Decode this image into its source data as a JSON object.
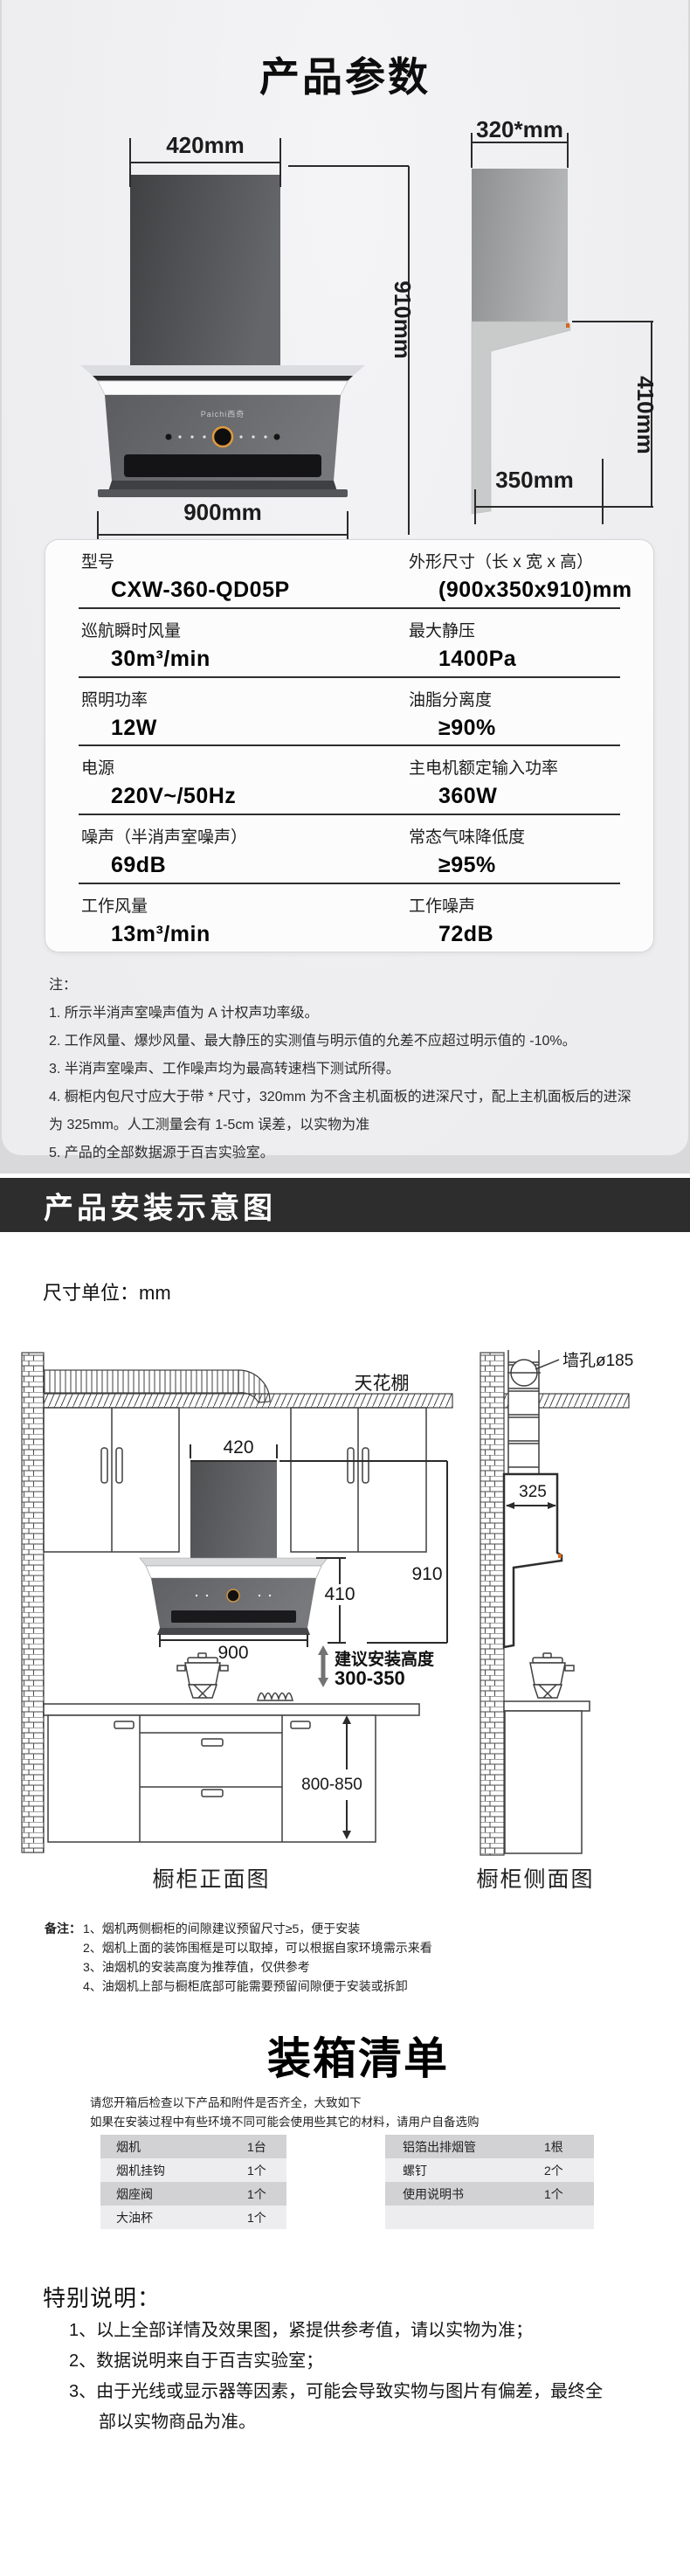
{
  "header": {
    "title": "产品参数"
  },
  "figure": {
    "brand": "Paichi西奇",
    "front": {
      "width_label": "420mm",
      "height_label": "910mm",
      "bottom_label": "900mm"
    },
    "side": {
      "width_label": "320*mm",
      "height_label": "410mm",
      "bottom_label": "350mm"
    }
  },
  "spec_table": {
    "rows": [
      {
        "left_label": "型号",
        "left_value": "CXW-360-QD05P",
        "right_label": "外形尺寸（长 x 宽 x 高）",
        "right_value": "(900x350x910)mm"
      },
      {
        "left_label": "巡航瞬时风量",
        "left_value": "30m³/min",
        "right_label": "最大静压",
        "right_value": "1400Pa"
      },
      {
        "left_label": "照明功率",
        "left_value": "12W",
        "right_label": "油脂分离度",
        "right_value": "≥90%"
      },
      {
        "left_label": "电源",
        "left_value": "220V~/50Hz",
        "right_label": "主电机额定输入功率",
        "right_value": "360W"
      },
      {
        "left_label": "噪声（半消声室噪声）",
        "left_value": "69dB",
        "right_label": "常态气味降低度",
        "right_value": "≥95%"
      },
      {
        "left_label": "工作风量",
        "left_value": "13m³/min",
        "right_label": "工作噪声",
        "right_value": "72dB"
      }
    ]
  },
  "notes": {
    "label": "注：",
    "items": [
      "1. 所示半消声室噪声值为 A 计权声功率级。",
      "2. 工作风量、爆炒风量、最大静压的实测值与明示值的允差不应超过明示值的 -10%。",
      "3. 半消声室噪声、工作噪声均为最高转速档下测试所得。",
      "4. 橱柜内包尺寸应大于带 * 尺寸，320mm 为不含主机面板的进深尺寸，配上主机面板后的进深为 325mm。人工测量会有 1-5cm 误差，以实物为准",
      "5. 产品的全部数据源于百吉实验室。"
    ]
  },
  "install": {
    "banner": "产品安装示意图",
    "unit": "尺寸单位：mm",
    "labels": {
      "ceiling": "天花棚",
      "chimney_width": "420",
      "total_height": "910",
      "hood_height": "410",
      "hood_width": "900",
      "suggest_title": "建议安装高度",
      "suggest_range": "300-350",
      "counter_height": "800-850",
      "front_caption": "橱柜正面图",
      "wall_hole": "墙孔ø185",
      "depth": "325",
      "side_caption": "橱柜侧面图"
    },
    "remarks": {
      "label": "备注：",
      "items": [
        "1、烟机两侧橱柜的间隙建议预留尺寸≥5，便于安装",
        "2、烟机上面的装饰围框是可以取掉，可以根据自家环境需示来看",
        "3、油烟机的安装高度为推荐值，仅供参考",
        "4、油烟机上部与橱柜底部可能需要预留间隙便于安装或拆卸"
      ]
    }
  },
  "packing": {
    "title": "装箱清单",
    "intro": [
      "请您开箱后检查以下产品和附件是否齐全，大致如下",
      "如果在安装过程中有些环境不同可能会使用些其它的材料，请用户自备选购"
    ],
    "left_rows": [
      {
        "name": "烟机",
        "qty": "1台"
      },
      {
        "name": "烟机挂钩",
        "qty": "1个"
      },
      {
        "name": "烟座阀",
        "qty": "1个"
      },
      {
        "name": "大油杯",
        "qty": "1个"
      }
    ],
    "right_rows": [
      {
        "name": "铝箔出排烟管",
        "qty": "1根"
      },
      {
        "name": "螺钉",
        "qty": "2个"
      },
      {
        "name": "使用说明书",
        "qty": "1个"
      },
      {
        "name": "",
        "qty": ""
      }
    ]
  },
  "special": {
    "heading": "特别说明：",
    "items": [
      "1、以上全部详情及效果图，紧提供参考值，请以实物为准；",
      "2、数据说明来自于百吉实验室；",
      "3、由于光线或显示器等因素，可能会导致实物与图片有偏差，最终全部以实物商品为准。"
    ]
  }
}
